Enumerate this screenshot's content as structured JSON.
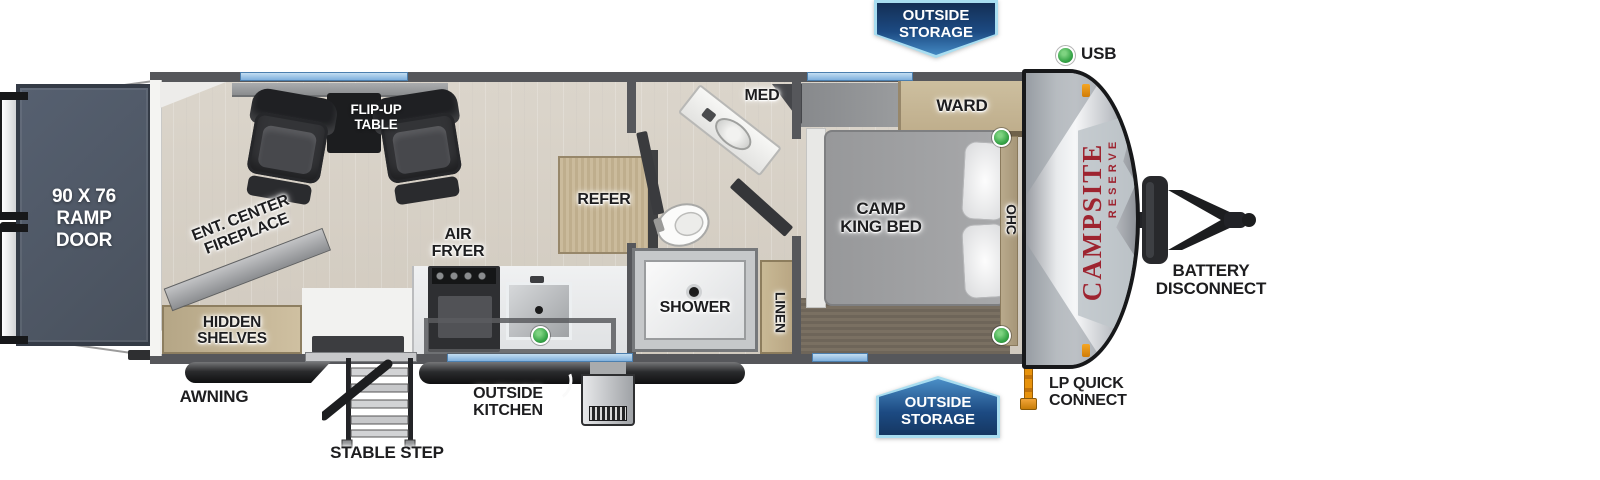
{
  "badges": {
    "top_outside_storage": "OUTSIDE\nSTORAGE",
    "bottom_outside_storage": "OUTSIDE\nSTORAGE"
  },
  "callouts": {
    "usb": "USB",
    "battery_disconnect": "BATTERY\nDISCONNECT",
    "lp_quick_connect": "LP QUICK\nCONNECT",
    "awning": "AWNING",
    "stable_step": "STABLE STEP",
    "outside_kitchen": "OUTSIDE\nKITCHEN"
  },
  "rooms": {
    "ramp_door": "90 X 76\nRAMP\nDOOR",
    "flip_up_table": "FLIP-UP\nTABLE",
    "ent_center_fireplace": "ENT. CENTER\nFIREPLACE",
    "hidden_shelves": "HIDDEN\nSHELVES",
    "air_fryer": "AIR\nFRYER",
    "refer": "REFER",
    "med": "MED",
    "shower": "SHOWER",
    "linen": "LINEN",
    "ward": "WARD",
    "camp_king_bed": "CAMP\nKING BED",
    "ohc": "OHC"
  },
  "brand": {
    "name": "CAMPSITE",
    "series": "RESERVE"
  },
  "colors": {
    "wall_gray": "#56575b",
    "floor_tan": "#d8d2c7",
    "ramp_gray": "#4d5663",
    "cabinet_tan": "#c8b795",
    "window_blue": "#8cbae4",
    "badge_blue_dark": "#142f55",
    "badge_blue": "#2e6fad",
    "badge_border": "#a8ddf0",
    "accent_green": "#36a447",
    "brand_red": "#9e2430",
    "lp_orange": "#e8930c"
  }
}
